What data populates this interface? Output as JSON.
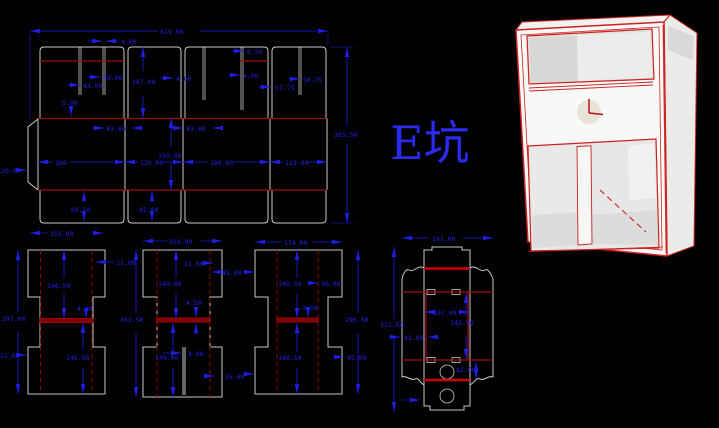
{
  "app": {
    "background": "#000000",
    "description": "CAD die-cut box drawing with 3D preview"
  },
  "colors": {
    "dimension_blue": "#1e1ee0",
    "cut_line_gray": "#c8c8c8",
    "crease_dark_red": "#9b1010",
    "crease_bright_red": "#d40000",
    "title_blue": "#2a2af0",
    "model_edge_red": "#cc2222",
    "model_face_white": "#f8f8f6"
  },
  "title": {
    "label": "E坑"
  },
  "spread": {
    "dims": {
      "total_width": "619.00",
      "slot_width": "4.00",
      "top_43_a": "43.00",
      "top_43_b": "43.00",
      "flap_height": "147.00",
      "top_4": "4.00",
      "step_5": "5.00",
      "right_050": "0.50",
      "right_4": "4.00",
      "right_5675": "56.75",
      "right_5775": "57.75",
      "panel_43_left": "43.00",
      "panel_43_right": "43.00",
      "panel_height": "150.00",
      "panel1_width": "180",
      "panel2_width": "120.00",
      "panel3_width": "180.00",
      "panel4_width": "119.00",
      "glue_tab": "20.00",
      "bottom_flap_a": "60.50",
      "bottom_flap_b": "82.00",
      "total_height": "365.50"
    }
  },
  "piece1": {
    "dims": {
      "width": "155.00",
      "height": "297.00",
      "top_notch": "21.00",
      "upper": "146.50",
      "crease": "4.00",
      "lower": "146.50",
      "bottom_notch": "21.00"
    }
  },
  "piece2": {
    "dims": {
      "width": "156.00",
      "height": "301.50",
      "top_notch": "21.00",
      "top_flap": "45.00",
      "upper": "149.00",
      "crease": "4.50",
      "lower": "149.00",
      "slit": "4.00",
      "bottom_flap": "35.00"
    }
  },
  "piece3": {
    "dims": {
      "width": "174.00",
      "height": "296.50",
      "upper": "146.50",
      "top_flap": "50.00",
      "crease": "3.50",
      "lower": "146.50",
      "bottom_flap": "45.00"
    }
  },
  "strip": {
    "dims": {
      "width": "191.00",
      "height": "321.50",
      "inner_width": "107.00",
      "inner_height": "145.50",
      "side_flap": "42.00",
      "hole_section": "82.00"
    }
  }
}
